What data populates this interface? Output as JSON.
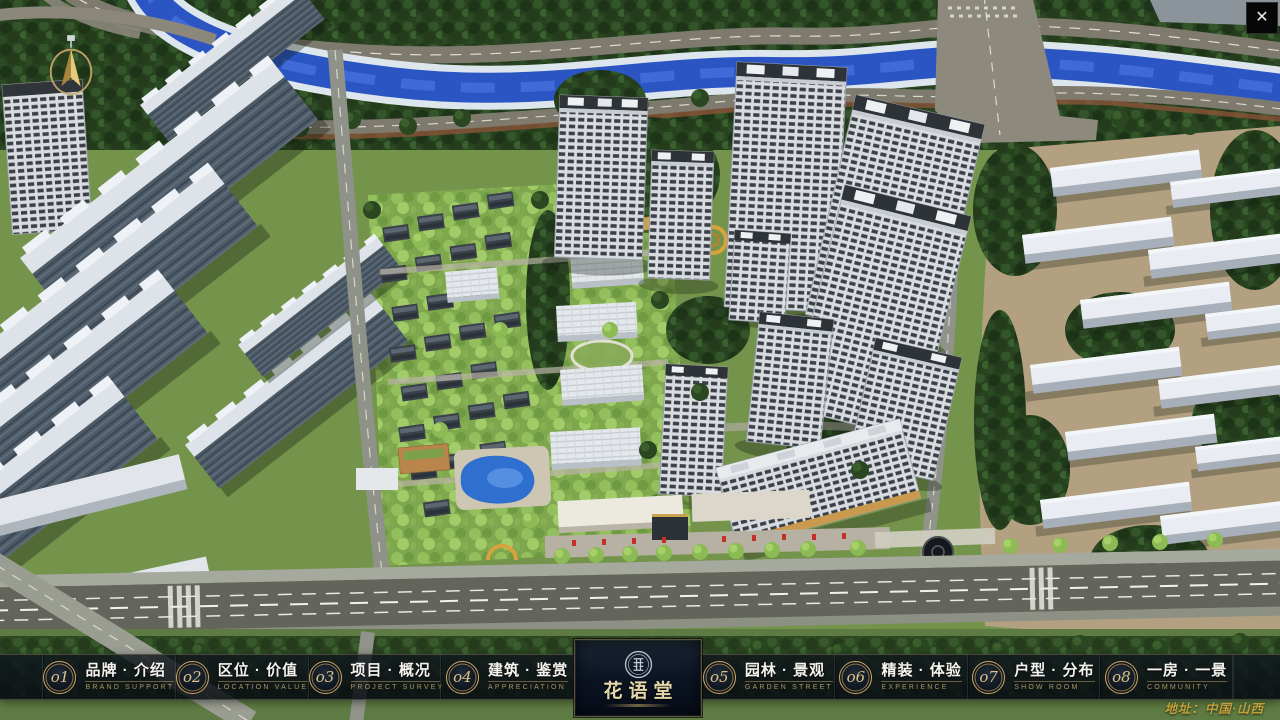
{
  "app": {
    "close_label": "✕",
    "address": "地址：中国·山西",
    "compass": "north-indicator"
  },
  "colors": {
    "gold": "#caa768",
    "bar_background": "rgba(13,18,26,0.82)",
    "title_text": "#f5f3ee",
    "subtitle_text": "#ab9660",
    "address_text": "#cca83c",
    "river_blue": "#2c55c4",
    "tree_green": "#2b4722"
  },
  "nav": {
    "items": [
      {
        "number": "o1",
        "title": "品牌 · 介绍",
        "subtitle": "BRAND SUPPORT"
      },
      {
        "number": "o2",
        "title": "区位 · 价值",
        "subtitle": "LOCATION VALUE"
      },
      {
        "number": "o3",
        "title": "项目 · 概况",
        "subtitle": "PROJECT SURVEY"
      },
      {
        "number": "o4",
        "title": "建筑 · 鉴赏",
        "subtitle": "APPRECIATION"
      },
      {
        "number": "o5",
        "title": "园林 · 景观",
        "subtitle": "GARDEN STREET"
      },
      {
        "number": "o6",
        "title": "精装 · 体验",
        "subtitle": "EXPERIENCE"
      },
      {
        "number": "o7",
        "title": "户型 · 分布",
        "subtitle": "SHOW ROOM"
      },
      {
        "number": "o8",
        "title": "一房 · 一景",
        "subtitle": "COMMUNITY"
      }
    ]
  },
  "logo": {
    "name": "花语堂",
    "emblem": "seal-icon"
  }
}
